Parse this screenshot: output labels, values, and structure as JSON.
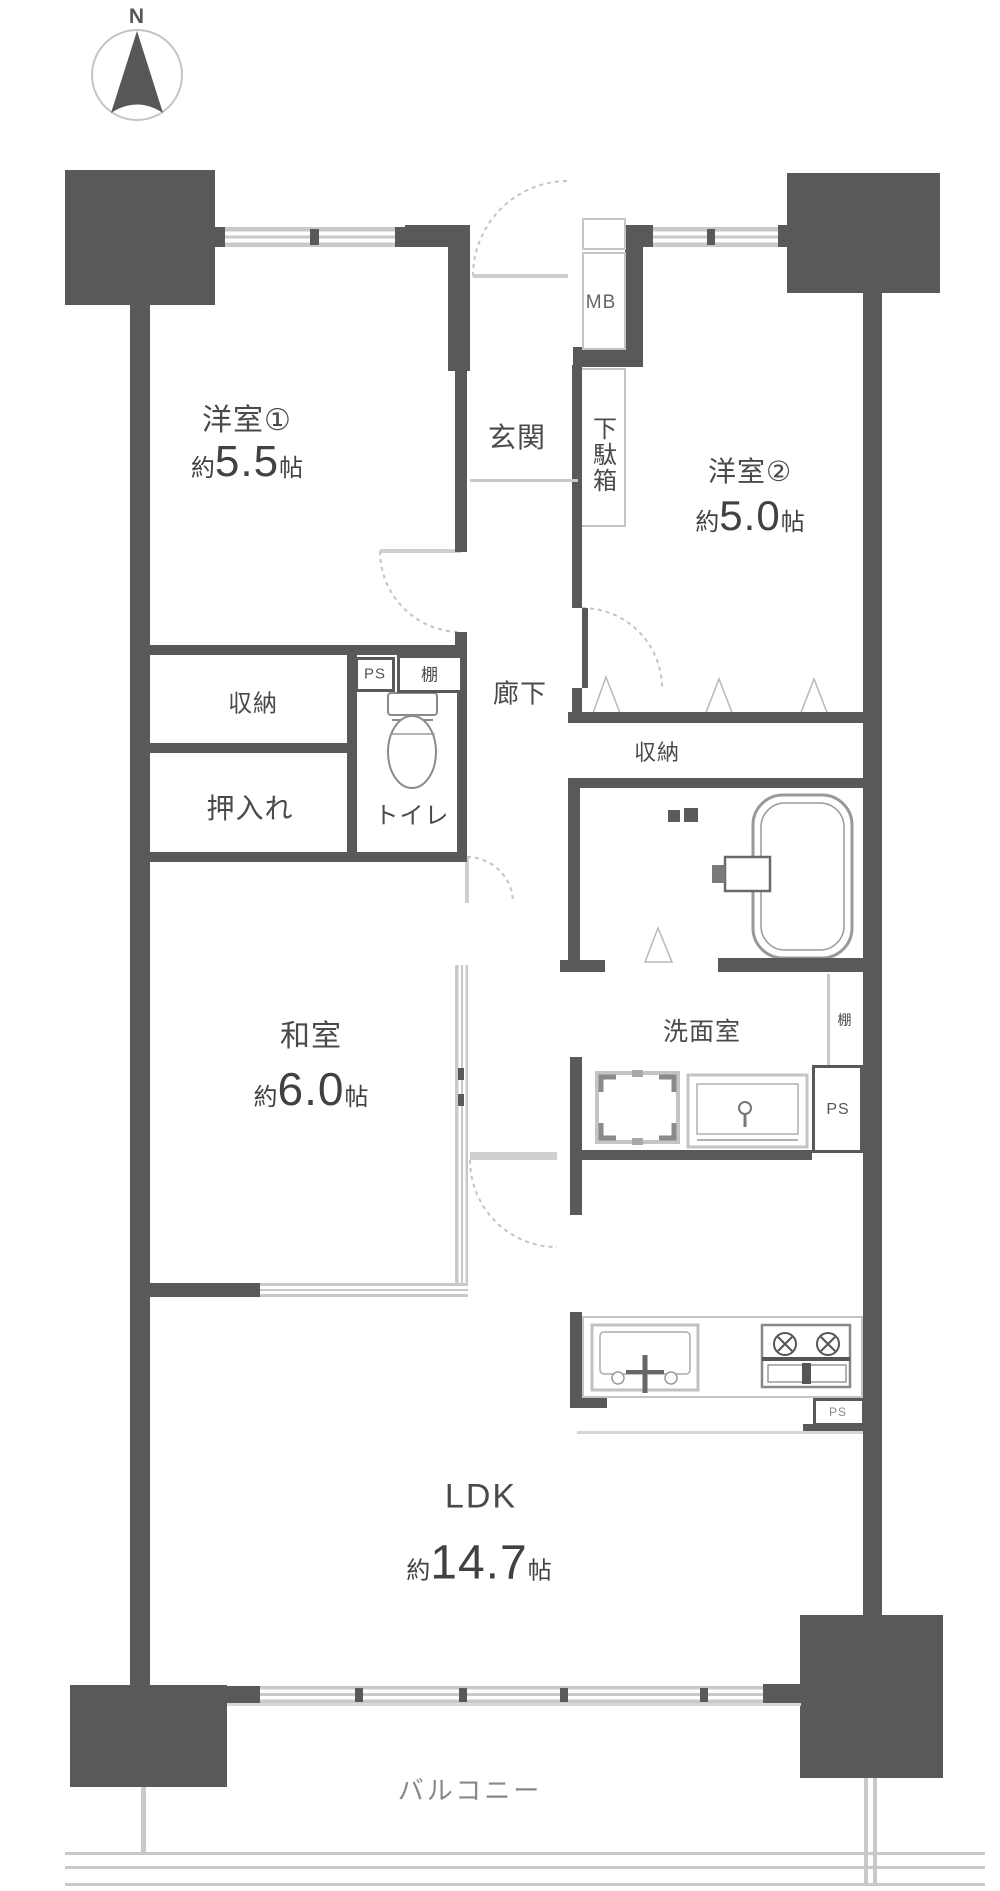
{
  "compass": {
    "north_label": "N"
  },
  "rooms": {
    "western1": {
      "name": "洋室①",
      "approx": "約",
      "area": "5.5",
      "unit": "帖"
    },
    "western2": {
      "name": "洋室②",
      "approx": "約",
      "area": "5.0",
      "unit": "帖"
    },
    "japanese": {
      "name": "和室",
      "approx": "約",
      "area": "6.0",
      "unit": "帖"
    },
    "ldk": {
      "name": "LDK",
      "approx": "約",
      "area": "14.7",
      "unit": "帖"
    }
  },
  "labels": {
    "entrance": "玄関",
    "shoe_cabinet": "下駄箱",
    "meter_box": "MB",
    "corridor": "廊下",
    "storage_west1": "収納",
    "oshiire": "押入れ",
    "toilet": "トイレ",
    "pipe_space_toilet": "PS",
    "shelf_toilet": "棚",
    "storage_west2": "収納",
    "washroom": "洗面室",
    "shelf_washroom": "棚",
    "pipe_space_washroom": "PS",
    "pipe_space_kitchen": "PS",
    "balcony": "バルコニー"
  },
  "colors": {
    "wall": "#595959",
    "window": "#c9c9c9",
    "text": "#4a4a4a"
  }
}
